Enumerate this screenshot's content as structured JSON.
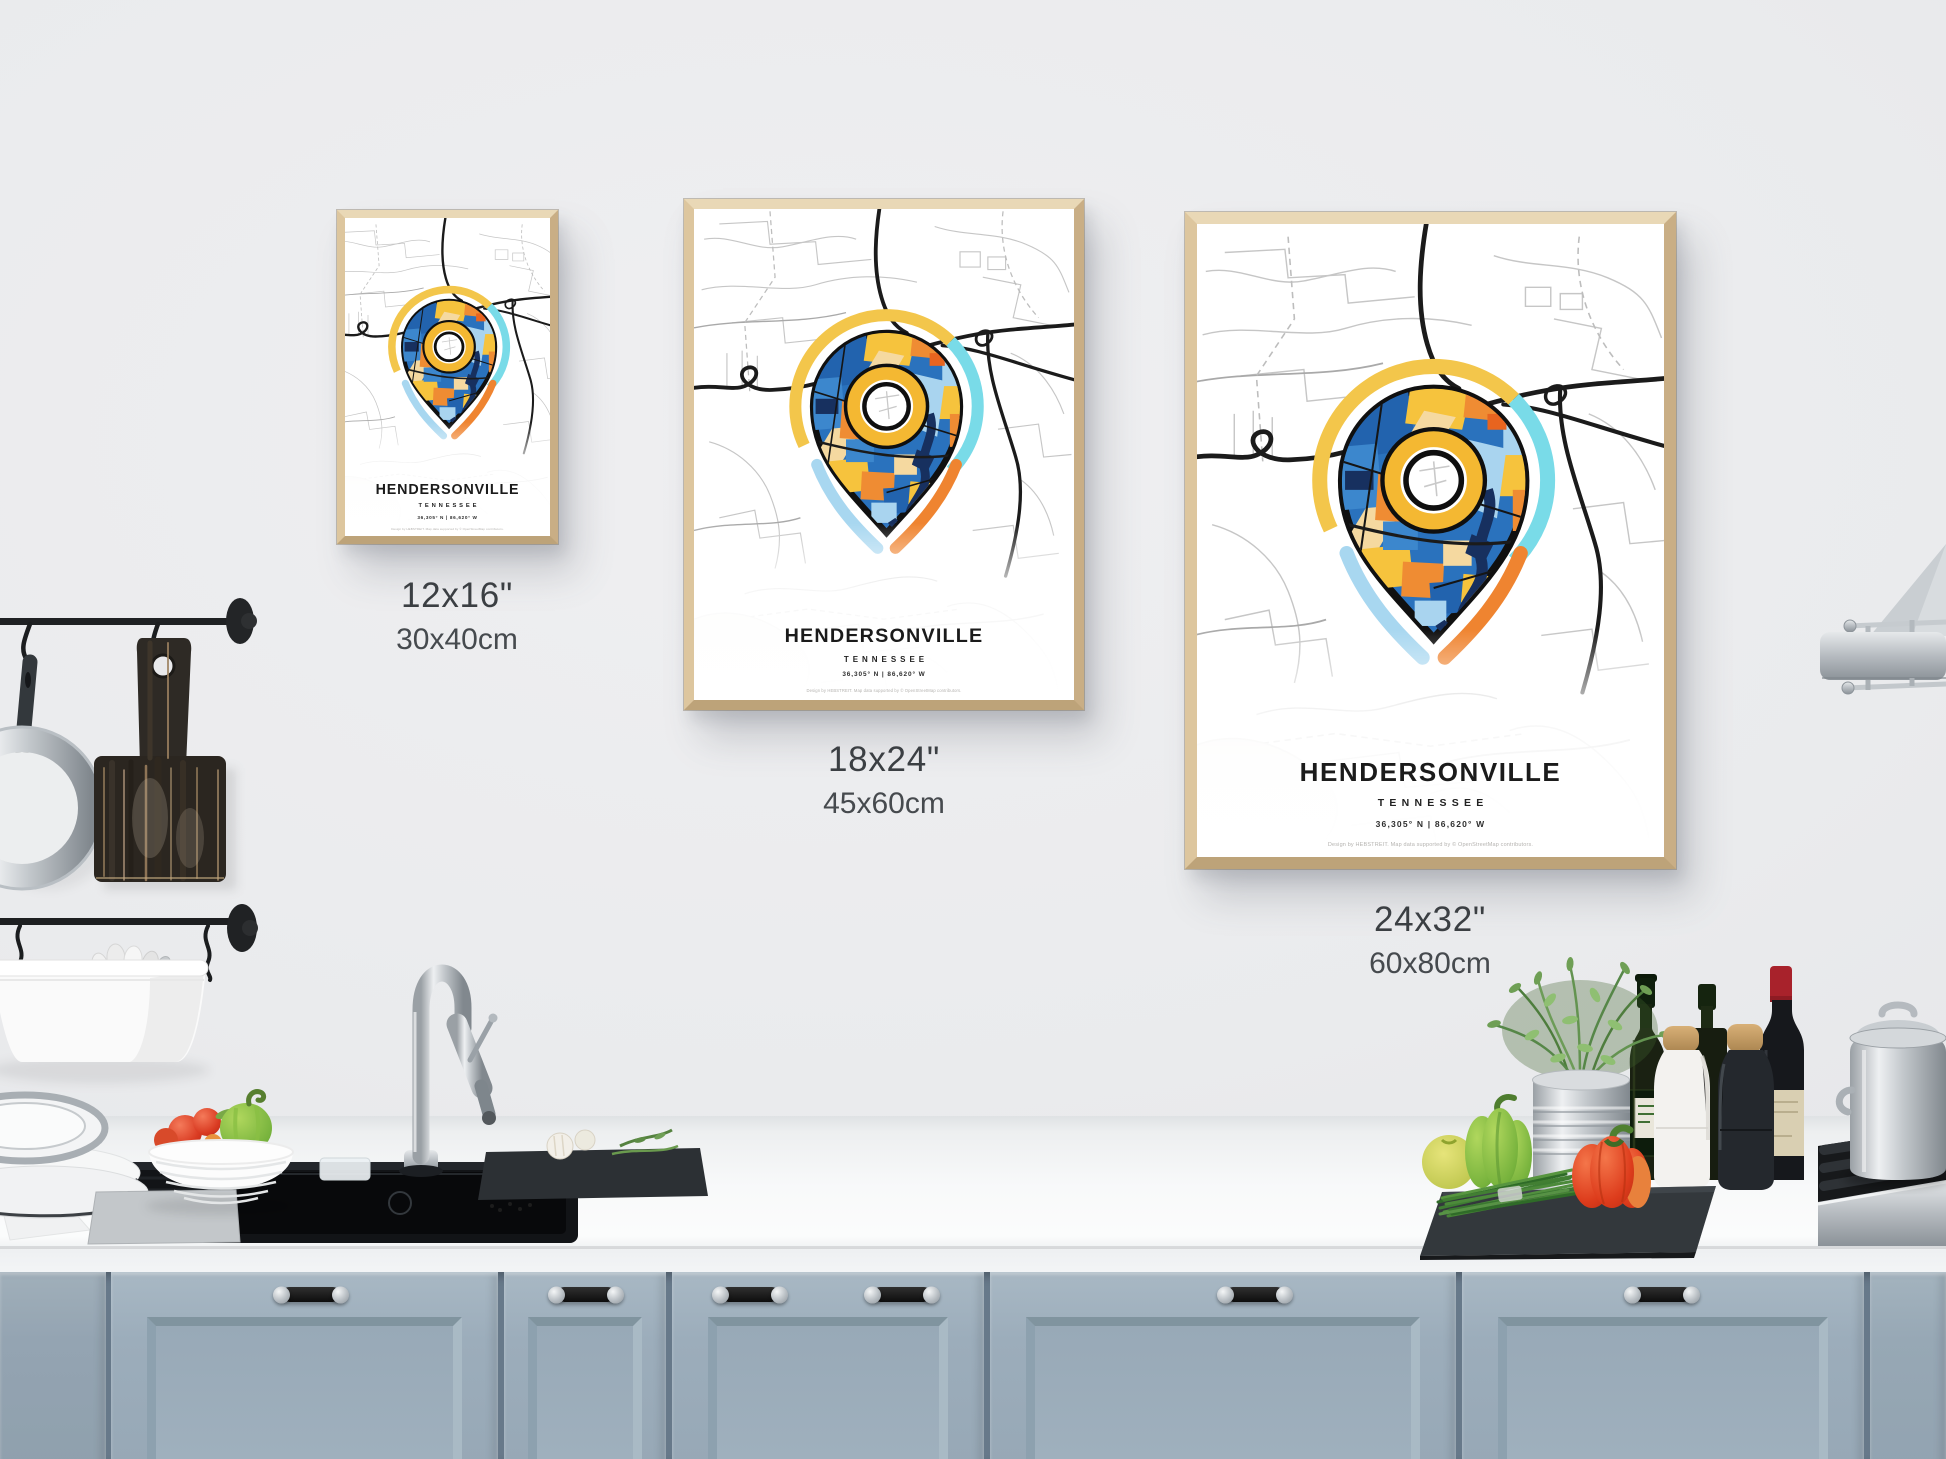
{
  "product": {
    "title": "HENDERSONVILLE",
    "state": "TENNESSEE",
    "coordinates": "36,305° N | 86,620° W",
    "credit": "Design by HEBSTREIT. Map data supported by © OpenStreetMap contributors.",
    "variants": [
      {
        "inches": "12x16\"",
        "metric": "30x40cm"
      },
      {
        "inches": "18x24\"",
        "metric": "45x60cm"
      },
      {
        "inches": "24x32\"",
        "metric": "60x80cm"
      }
    ]
  },
  "colors": {
    "wall": "#eaebed",
    "frame_wood": "#d7bf99",
    "cabinet_blue": "#9cadbb",
    "counter_white": "#f8f9fa",
    "pin_blue": "#2263ae",
    "pin_navy": "#17305f",
    "pin_yellow": "#f6c33d",
    "pin_orange": "#ef8c33",
    "pin_lightblue": "#a9d4ef",
    "halo_cyan": "#79dbe8",
    "halo_yellow": "#f3c64b",
    "road_black": "#1b1b1b"
  }
}
